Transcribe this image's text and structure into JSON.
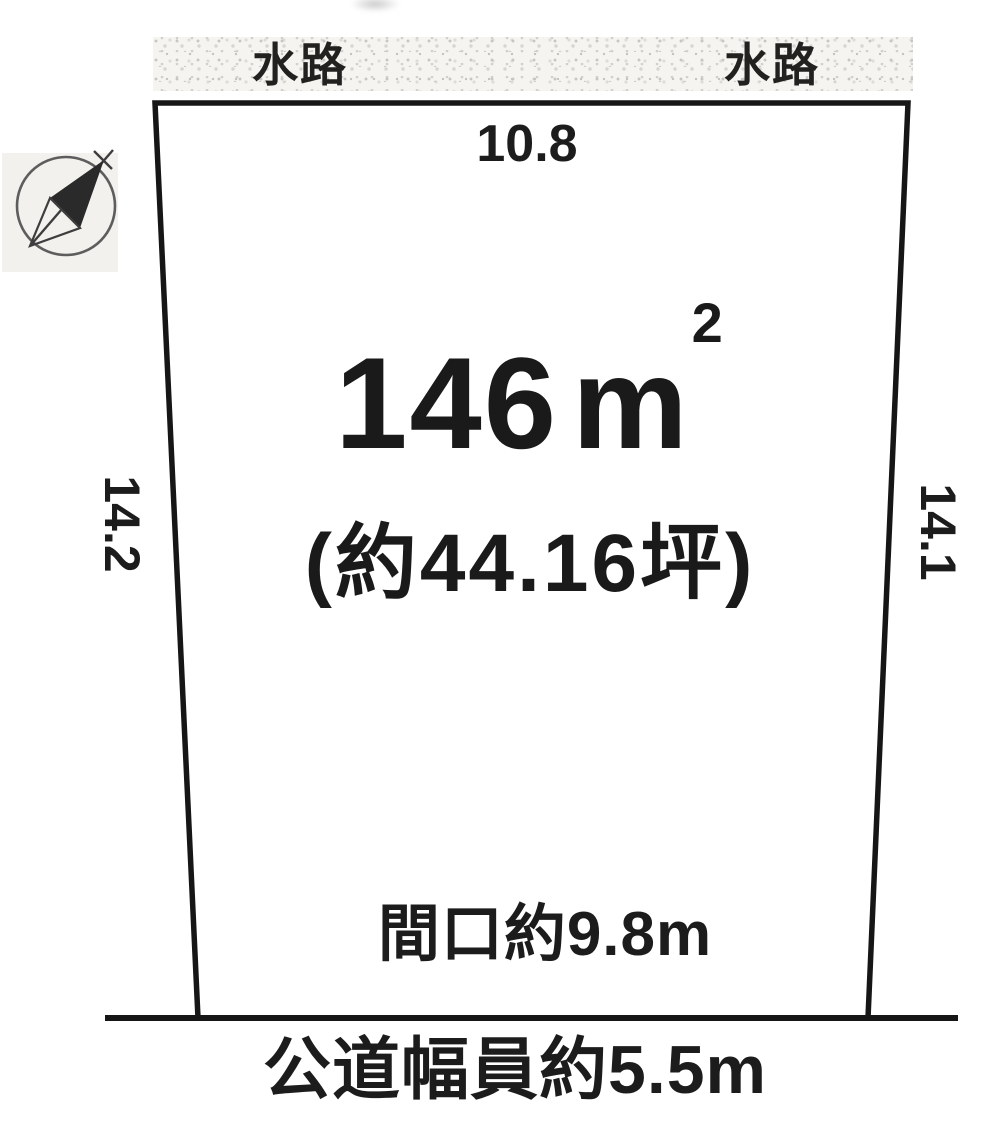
{
  "waterway_band": {
    "left_label": "水路",
    "right_label": "水路"
  },
  "plot": {
    "top_dimension": "10.8",
    "left_dimension": "14.2",
    "right_dimension": "14.1",
    "area_value": "146",
    "area_unit": "m",
    "area_exponent": "2",
    "area_tsubo": "(約44.16坪)",
    "frontage_label": "間口約9.8m"
  },
  "road": {
    "label": "公道幅員約5.5m"
  },
  "compass": {
    "icon": "north-arrow-icon",
    "direction": "northeast"
  },
  "colors": {
    "line": "#161616",
    "text": "#1c1c1c",
    "band_bg": "#f5f4f1",
    "speckle": "#c8c6c2",
    "compass_bg": "#f2f1ee"
  }
}
